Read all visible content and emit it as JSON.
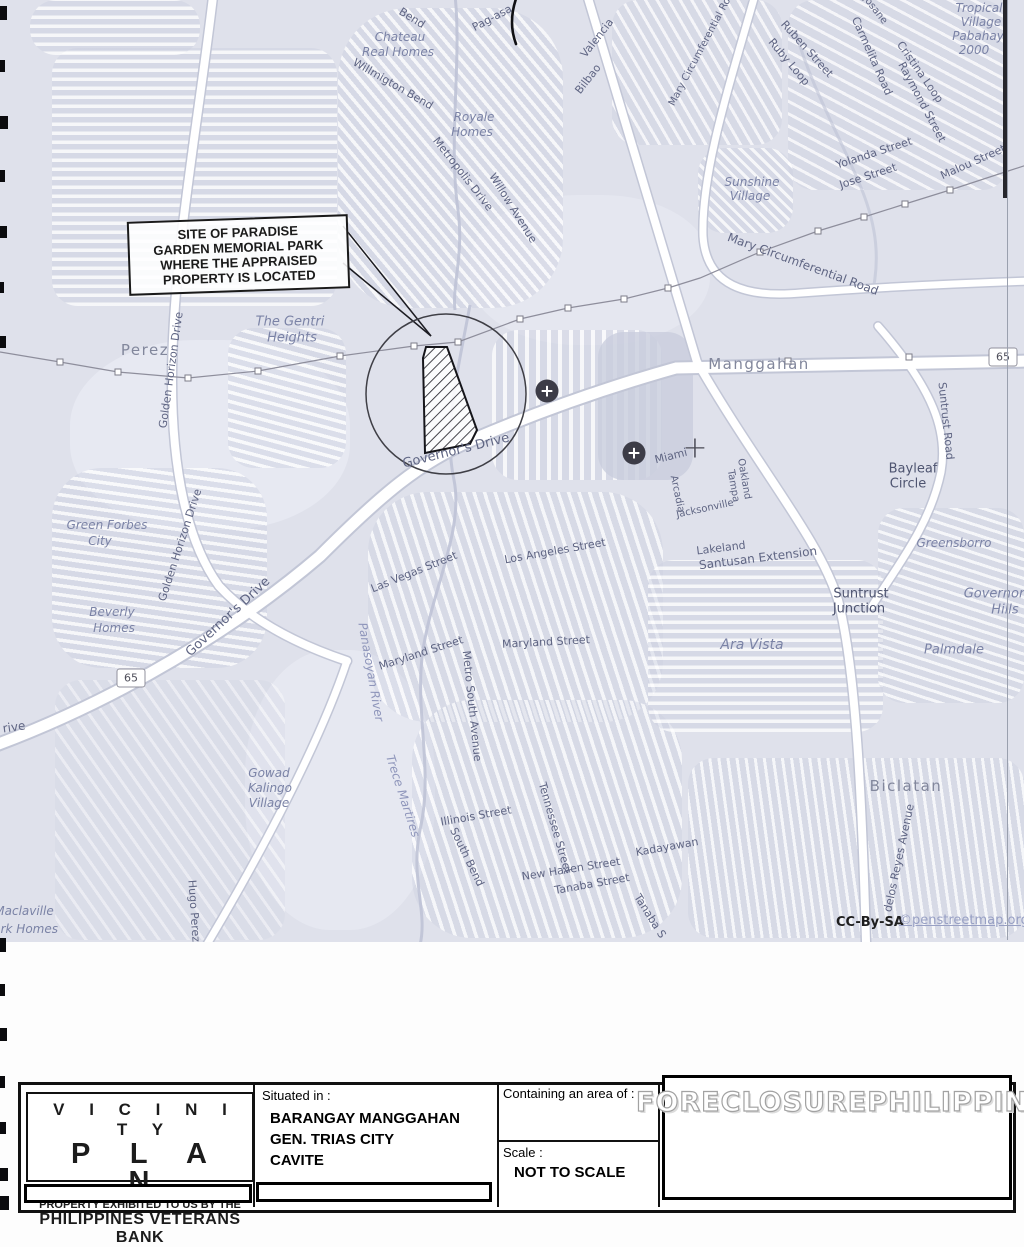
{
  "map": {
    "callout": {
      "lines": [
        "SITE OF PARADISE",
        "GARDEN MEMORIAL PARK",
        "WHERE THE APPRAISED",
        "PROPERTY IS LOCATED"
      ]
    },
    "attribution": {
      "prefix": "CC-By-SA",
      "link": "©penstreetmap.org"
    },
    "shields": [
      {
        "label": "65",
        "x": 1003,
        "y": 357
      },
      {
        "label": "65",
        "x": 131,
        "y": 678
      }
    ],
    "markers": {
      "hospital": [
        {
          "x": 547,
          "y": 391
        },
        {
          "x": 634,
          "y": 453
        }
      ],
      "cross": [
        {
          "x": 695,
          "y": 448
        }
      ]
    },
    "labels": [
      {
        "t": "Bend",
        "x": 412,
        "y": 18,
        "r": 32,
        "c": "st"
      },
      {
        "t": "Pag-asa",
        "x": 492,
        "y": 18,
        "r": -28,
        "c": "st"
      },
      {
        "t": "Valencia",
        "x": 597,
        "y": 38,
        "r": -52,
        "c": "st"
      },
      {
        "t": "Bilbao",
        "x": 588,
        "y": 79,
        "r": -52,
        "c": "st"
      },
      {
        "t": "Willmigton Bend",
        "x": 393,
        "y": 84,
        "r": 30,
        "c": "st"
      },
      {
        "t": "Metropolis Drive",
        "x": 463,
        "y": 174,
        "r": 52,
        "c": "st"
      },
      {
        "t": "Willow Avenue",
        "x": 513,
        "y": 208,
        "r": 58,
        "c": "st"
      },
      {
        "t": "Mary Circumferential Ro",
        "x": 700,
        "y": 52,
        "r": -62,
        "s": 10,
        "c": "st"
      },
      {
        "t": "Ruben Street",
        "x": 807,
        "y": 49,
        "r": 48,
        "c": "st"
      },
      {
        "t": "Ruby Loop",
        "x": 789,
        "y": 62,
        "r": 50,
        "c": "st"
      },
      {
        "t": "Josane",
        "x": 875,
        "y": 10,
        "r": 52,
        "s": 10,
        "c": "st"
      },
      {
        "t": "Carmelita Road",
        "x": 872,
        "y": 56,
        "r": 66,
        "c": "st"
      },
      {
        "t": "Cristina Loop",
        "x": 920,
        "y": 72,
        "r": 55,
        "c": "st"
      },
      {
        "t": "Raymond Street",
        "x": 922,
        "y": 102,
        "r": 62,
        "c": "st"
      },
      {
        "t": "Yolanda Street",
        "x": 874,
        "y": 153,
        "r": -18,
        "c": "st"
      },
      {
        "t": "Jose Street",
        "x": 868,
        "y": 176,
        "r": -18,
        "c": "st"
      },
      {
        "t": "Malou Street",
        "x": 973,
        "y": 162,
        "r": -24,
        "c": "st"
      },
      {
        "t": "Mary Circumferential Road",
        "x": 803,
        "y": 264,
        "r": 20,
        "s": 12,
        "c": "st"
      },
      {
        "t": "Suntrust Road",
        "x": 946,
        "y": 421,
        "r": 84,
        "c": "st"
      },
      {
        "t": "Governor's Drive",
        "x": 456,
        "y": 451,
        "r": -14,
        "s": 13,
        "c": "st"
      },
      {
        "t": "Governor's Drive",
        "x": 228,
        "y": 617,
        "r": -43,
        "s": 13,
        "c": "st"
      },
      {
        "t": "Golden Horizon Drive",
        "x": 171,
        "y": 370,
        "r": -82,
        "c": "st"
      },
      {
        "t": "Golden Horizon Drive",
        "x": 180,
        "y": 545,
        "r": -72,
        "c": "st"
      },
      {
        "t": "Las Vegas Street",
        "x": 414,
        "y": 572,
        "r": -22,
        "c": "st"
      },
      {
        "t": "Los Angeles Street",
        "x": 555,
        "y": 551,
        "r": -10,
        "c": "st"
      },
      {
        "t": "Maryland Street",
        "x": 421,
        "y": 653,
        "r": -18,
        "c": "st"
      },
      {
        "t": "Maryland Street",
        "x": 546,
        "y": 642,
        "r": -3,
        "c": "st"
      },
      {
        "t": "Metro South Avenue",
        "x": 472,
        "y": 706,
        "r": 84,
        "c": "st"
      },
      {
        "t": "Illinois Street",
        "x": 476,
        "y": 816,
        "r": -10,
        "c": "st"
      },
      {
        "t": "South Bend",
        "x": 467,
        "y": 857,
        "r": 64,
        "c": "st"
      },
      {
        "t": "Tennessee Street",
        "x": 555,
        "y": 828,
        "r": 74,
        "c": "st"
      },
      {
        "t": "New Haven Street",
        "x": 571,
        "y": 869,
        "r": -9,
        "c": "st"
      },
      {
        "t": "Tanaba Street",
        "x": 592,
        "y": 884,
        "r": -10,
        "c": "st"
      },
      {
        "t": "Tanaba S",
        "x": 650,
        "y": 916,
        "r": 58,
        "c": "st"
      },
      {
        "t": "Kadayawan",
        "x": 667,
        "y": 847,
        "r": -10,
        "c": "st"
      },
      {
        "t": "Hugo Perez",
        "x": 194,
        "y": 911,
        "r": 86,
        "c": "st"
      },
      {
        "t": "rive",
        "x": 14,
        "y": 727,
        "r": -8,
        "s": 12,
        "c": "st"
      },
      {
        "t": "Miami",
        "x": 671,
        "y": 456,
        "r": -14,
        "c": "st"
      },
      {
        "t": "Arcadia",
        "x": 677,
        "y": 494,
        "r": 78,
        "s": 10,
        "c": "st"
      },
      {
        "t": "Jacksonville",
        "x": 705,
        "y": 509,
        "r": -12,
        "s": 10,
        "c": "st"
      },
      {
        "t": "Oakland",
        "x": 744,
        "y": 479,
        "r": 80,
        "s": 10,
        "c": "st"
      },
      {
        "t": "Tampa",
        "x": 733,
        "y": 486,
        "r": 80,
        "s": 10,
        "c": "st"
      },
      {
        "t": "Lakeland",
        "x": 721,
        "y": 548,
        "r": -7,
        "c": "st"
      },
      {
        "t": "Santusan Extension",
        "x": 758,
        "y": 558,
        "r": -7,
        "s": 12,
        "c": "st"
      },
      {
        "t": "delos Reyes Avenue",
        "x": 899,
        "y": 858,
        "r": -78,
        "c": "st"
      },
      {
        "t": "Bayleaf",
        "x": 913,
        "y": 469,
        "c": "dk"
      },
      {
        "t": "Circle",
        "x": 908,
        "y": 484,
        "c": "dk"
      },
      {
        "t": "Suntrust",
        "x": 861,
        "y": 594,
        "c": "dk"
      },
      {
        "t": "Junction",
        "x": 859,
        "y": 609,
        "c": "dk"
      },
      {
        "t": "Chateau",
        "x": 400,
        "y": 37,
        "c": "pl"
      },
      {
        "t": "Real Homes",
        "x": 398,
        "y": 52,
        "c": "pl"
      },
      {
        "t": "Royale",
        "x": 474,
        "y": 117,
        "c": "pl"
      },
      {
        "t": "Homes",
        "x": 472,
        "y": 132,
        "c": "pl"
      },
      {
        "t": "Sunshine",
        "x": 752,
        "y": 182,
        "c": "pl"
      },
      {
        "t": "Village",
        "x": 750,
        "y": 196,
        "c": "pl"
      },
      {
        "t": "The Gentri",
        "x": 290,
        "y": 322,
        "s": 13,
        "c": "pl"
      },
      {
        "t": "Heights",
        "x": 292,
        "y": 338,
        "s": 13,
        "c": "pl"
      },
      {
        "t": "Green Forbes",
        "x": 107,
        "y": 525,
        "c": "pl"
      },
      {
        "t": "City",
        "x": 100,
        "y": 541,
        "c": "pl"
      },
      {
        "t": "Beverly",
        "x": 112,
        "y": 612,
        "c": "pl"
      },
      {
        "t": "Homes",
        "x": 114,
        "y": 628,
        "c": "pl"
      },
      {
        "t": "Gowad",
        "x": 269,
        "y": 773,
        "c": "pl"
      },
      {
        "t": "Kalingo",
        "x": 270,
        "y": 788,
        "c": "pl"
      },
      {
        "t": "Village",
        "x": 269,
        "y": 803,
        "c": "pl"
      },
      {
        "t": "Maclaville",
        "x": 24,
        "y": 911,
        "c": "pl"
      },
      {
        "t": "Park Homes",
        "x": 22,
        "y": 929,
        "c": "pl"
      },
      {
        "t": "Greensborro",
        "x": 954,
        "y": 543,
        "c": "pl"
      },
      {
        "t": "Governor",
        "x": 994,
        "y": 594,
        "s": 13,
        "c": "pl"
      },
      {
        "t": "Hills",
        "x": 1005,
        "y": 610,
        "s": 13,
        "c": "pl"
      },
      {
        "t": "Ara Vista",
        "x": 752,
        "y": 645,
        "s": 14,
        "c": "pl"
      },
      {
        "t": "Palmdale",
        "x": 954,
        "y": 650,
        "s": 13,
        "c": "pl"
      },
      {
        "t": "Tropical",
        "x": 979,
        "y": 8,
        "c": "pl"
      },
      {
        "t": "Village",
        "x": 981,
        "y": 22,
        "c": "pl"
      },
      {
        "t": "Pabahay",
        "x": 978,
        "y": 36,
        "c": "pl"
      },
      {
        "t": "2000",
        "x": 974,
        "y": 50,
        "c": "pl"
      },
      {
        "t": "Manggahan",
        "x": 759,
        "y": 364,
        "c": "tn"
      },
      {
        "t": "Perez",
        "x": 145,
        "y": 350,
        "c": "tn"
      },
      {
        "t": "Biclatan",
        "x": 906,
        "y": 786,
        "c": "tn"
      },
      {
        "t": "Panasoyan River",
        "x": 371,
        "y": 672,
        "r": 80,
        "c": "rv"
      },
      {
        "t": "Trece Martires",
        "x": 403,
        "y": 796,
        "r": 72,
        "c": "rv"
      }
    ]
  },
  "title_block": {
    "title_line1": "V I C I N I T Y",
    "title_line2": "P L A N",
    "exhibited_line1": "PROPERTY EXHIBITED TO US BY THE",
    "exhibited_line2": "PHILIPPINES VETERANS BANK",
    "situated_label": "Situated in :",
    "situated": [
      "BARANGAY MANGGAHAN",
      "GEN. TRIAS CITY",
      "CAVITE"
    ],
    "area_label": "Containing an area of :",
    "scale_label": "Scale :",
    "scale_value": "NOT TO SCALE",
    "watermark": "FORECLOSUREPHILIPPINES.COM"
  }
}
